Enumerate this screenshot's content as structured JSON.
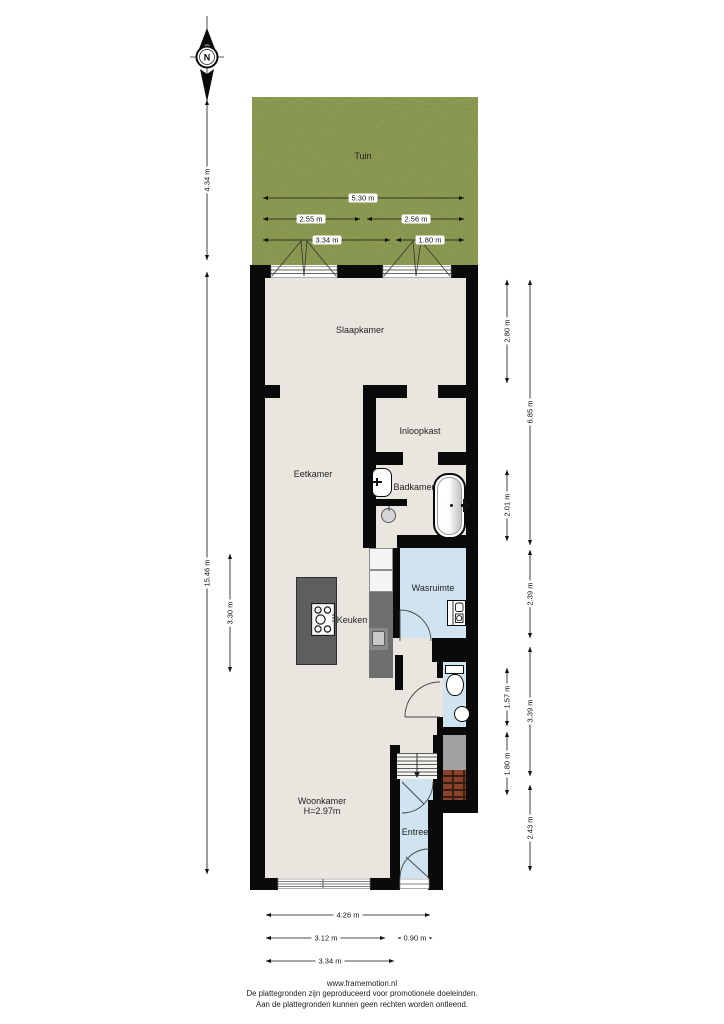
{
  "compass": {
    "north_label": "N"
  },
  "rooms": {
    "tuin": "Tuin",
    "slaapkamer": "Slaapkamer",
    "inloopkast": "Inloopkast",
    "eetkamer": "Eetkamer",
    "badkamer": "Badkamer",
    "wasruimte": "Wasruimte",
    "keuken": "Keuken",
    "woonkamer": "Woonkamer",
    "woonkamer_height": "H=2.97m",
    "entree": "Entree"
  },
  "garden_dims": {
    "total_width": "5.30 m",
    "left_half": "2.55 m",
    "right_half": "2.56 m",
    "left_part": "3.34 m",
    "right_part": "1.80 m"
  },
  "dims_left": {
    "garden_depth": "4.34 m",
    "house_depth": "15.46 m",
    "kitchen": "3.30 m"
  },
  "dims_right": [
    "2.80 m",
    "6.85 m",
    "2.01 m",
    "2.39 m",
    "1.57 m",
    "3.39 m",
    "1.80 m",
    "2.43 m"
  ],
  "dims_bottom": [
    "4.26 m",
    "3.12 m",
    "0.90 m",
    "3.34 m"
  ],
  "footer": {
    "url": "www.framemotion.nl",
    "line1": "De plattegronden zijn geproduceerd voor promotionele doeleinden.",
    "line2": "Aan de plattegronden kunnen geen rechten worden ontleend."
  },
  "colors": {
    "wall": "#0a0a0a",
    "floor": "#e9e6df",
    "wet_floor": "#cfe4f0",
    "garden": "#7b8c41",
    "counter": "#6f6f6f",
    "island": "#5e5e5e",
    "brick": "#8a4129",
    "patio": "#a2a2a2"
  }
}
